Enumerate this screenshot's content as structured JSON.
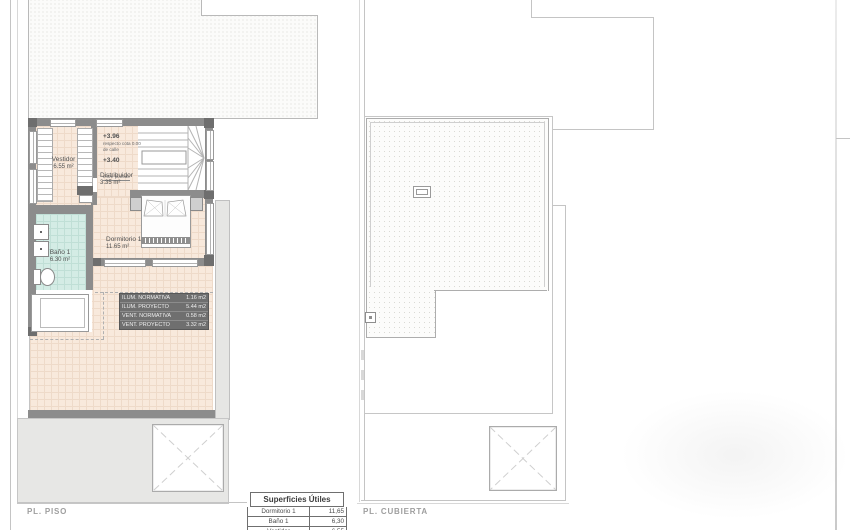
{
  "plans": {
    "piso": {
      "label": "PL. PISO",
      "rooms": [
        {
          "name": "Vestidor",
          "area": "6.55 m²"
        },
        {
          "name": "Distribuidor",
          "area": "3.35 m²"
        },
        {
          "name": "Dormitorio 1",
          "area": "11.65 m²"
        },
        {
          "name": "Baño 1",
          "area": "6.30 m²"
        }
      ],
      "levels": {
        "upper": {
          "value": "+3.96",
          "note1": "respecto cota 0.00",
          "note2": "de calle"
        },
        "inter": {
          "value": "+3.40",
          "note": "entre plantas"
        }
      },
      "lum_vent": {
        "rows": [
          {
            "label": "ILUM. NORMATIVA",
            "value": "1.16 m2"
          },
          {
            "label": "ILUM. PROYECTO",
            "value": "5.44 m2"
          },
          {
            "label": "VENT. NORMATIVA",
            "value": "0.58 m2"
          },
          {
            "label": "VENT. PROYECTO",
            "value": "3.32 m2"
          }
        ]
      }
    },
    "cubierta": {
      "label": "PL. CUBIERTA"
    }
  },
  "areas_table": {
    "title": "Superficies Útiles",
    "rows": [
      {
        "name": "Dormitorio 1",
        "value": "11,65"
      },
      {
        "name": "Baño 1",
        "value": "6,30"
      },
      {
        "name": "Vestidor",
        "value": "6,55"
      }
    ]
  },
  "colors": {
    "wall": "#8c8c8c",
    "floor_fill": "#f8e9dc",
    "bath_fill": "#d4ece5",
    "paving": "#e7e7e5",
    "boundary_line": "#c4c4c4"
  }
}
